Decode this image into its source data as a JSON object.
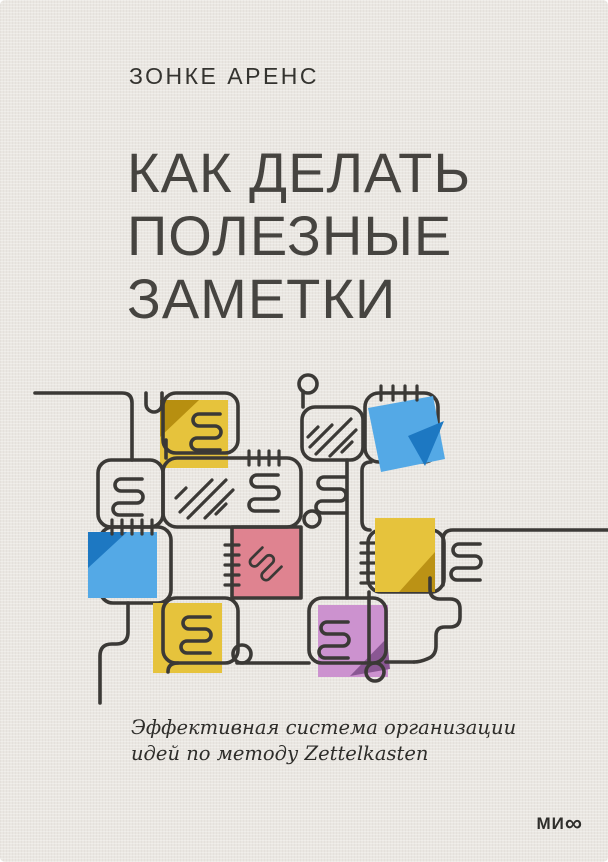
{
  "cover": {
    "author": "ЗОНКЕ АРЕНС",
    "title_lines": [
      "КАК ДЕЛАТЬ",
      "ПОЛЕЗНЫЕ",
      "ЗАМЕТКИ"
    ],
    "subtitle_lines": [
      "Эффективная система организации",
      "идей по методу Zettelkasten"
    ],
    "publisher_logo": "МИ∞",
    "publisher_logo_prefix": "МИ",
    "publisher_logo_infinity": "∞"
  },
  "illustration": {
    "description": "Looping line network of connected note cards with squiggle text marks, diagonal hatching, stitch ticks and colored sticky notes (Zettelkasten slip-box metaphor)",
    "background_color": "#eae7e2",
    "line_color": "#3b3936",
    "sticky_notes": [
      {
        "name": "yellow-note-top-left",
        "color": "#e6c33c",
        "fold_color": "#b78f10"
      },
      {
        "name": "blue-note-top-right",
        "color": "#54a9e6",
        "fold_color": "#1d78c2"
      },
      {
        "name": "blue-note-left",
        "color": "#54a9e6",
        "fold_color": "#1d78c2"
      },
      {
        "name": "pink-note-center",
        "color": "#df8390",
        "fold_color": null
      },
      {
        "name": "yellow-note-right",
        "color": "#e6c33c",
        "fold_color": "#bb9215"
      },
      {
        "name": "yellow-note-bottom",
        "color": "#e6c33c",
        "fold_color": null
      },
      {
        "name": "purple-note-bottom",
        "color": "#cc92cf",
        "fold_color": "#8a5793"
      }
    ]
  },
  "text_colors": {
    "author": "#34332f",
    "title": "#464440",
    "subtitle": "#2e2d2a",
    "logo": "#2f2e2b"
  }
}
